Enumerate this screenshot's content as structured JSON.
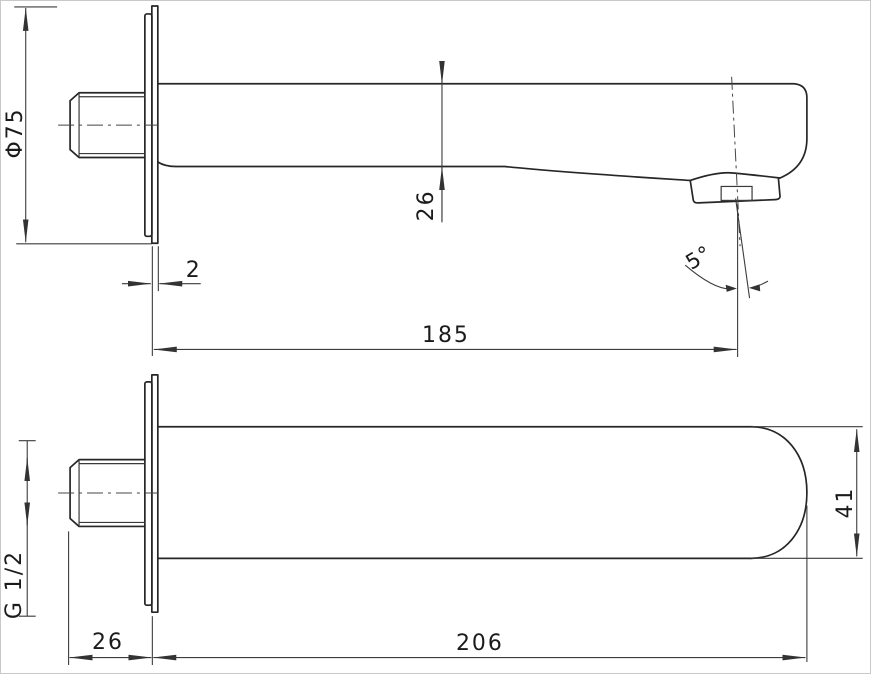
{
  "drawing": {
    "colors": {
      "part_line": "#262626",
      "dimension_line": "#3c3c3c",
      "text": "#1b1b1b",
      "background": "#ffffff",
      "frame_border": "#c9c9c9"
    },
    "views": {
      "side_view": {
        "dims": {
          "flange_diameter": "Φ75",
          "flange_thickness": "2",
          "spout_height": "26",
          "projection_length": "185",
          "outlet_angle": "5°"
        }
      },
      "plan_view": {
        "dims": {
          "thread_size": "G 1/2",
          "thread_length": "26",
          "overall_length": "206",
          "spout_width": "41"
        }
      }
    }
  }
}
